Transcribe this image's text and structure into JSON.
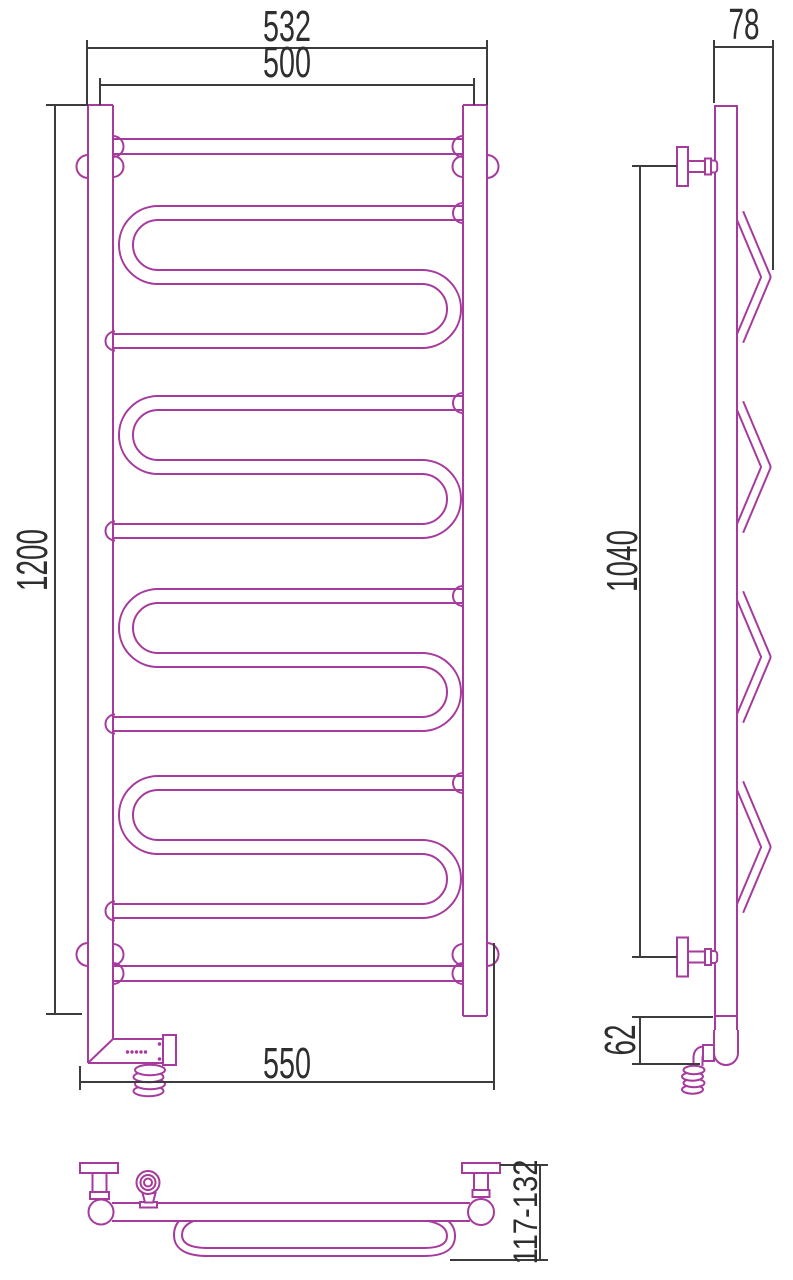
{
  "drawing": {
    "colors": {
      "outline": "#a63a9d",
      "dimension": "#3c3c3e",
      "label": "#2e2e30",
      "background": "#ffffff"
    },
    "views": {
      "front": {
        "dim_width_outer": "532",
        "dim_width_centers": "500",
        "dim_height": "1200",
        "dim_width_overall": "550"
      },
      "side": {
        "dim_depth": "78",
        "dim_bracket_span": "1040",
        "dim_heater_height": "62"
      },
      "top": {
        "dim_wall_offset": "117-132"
      }
    }
  }
}
